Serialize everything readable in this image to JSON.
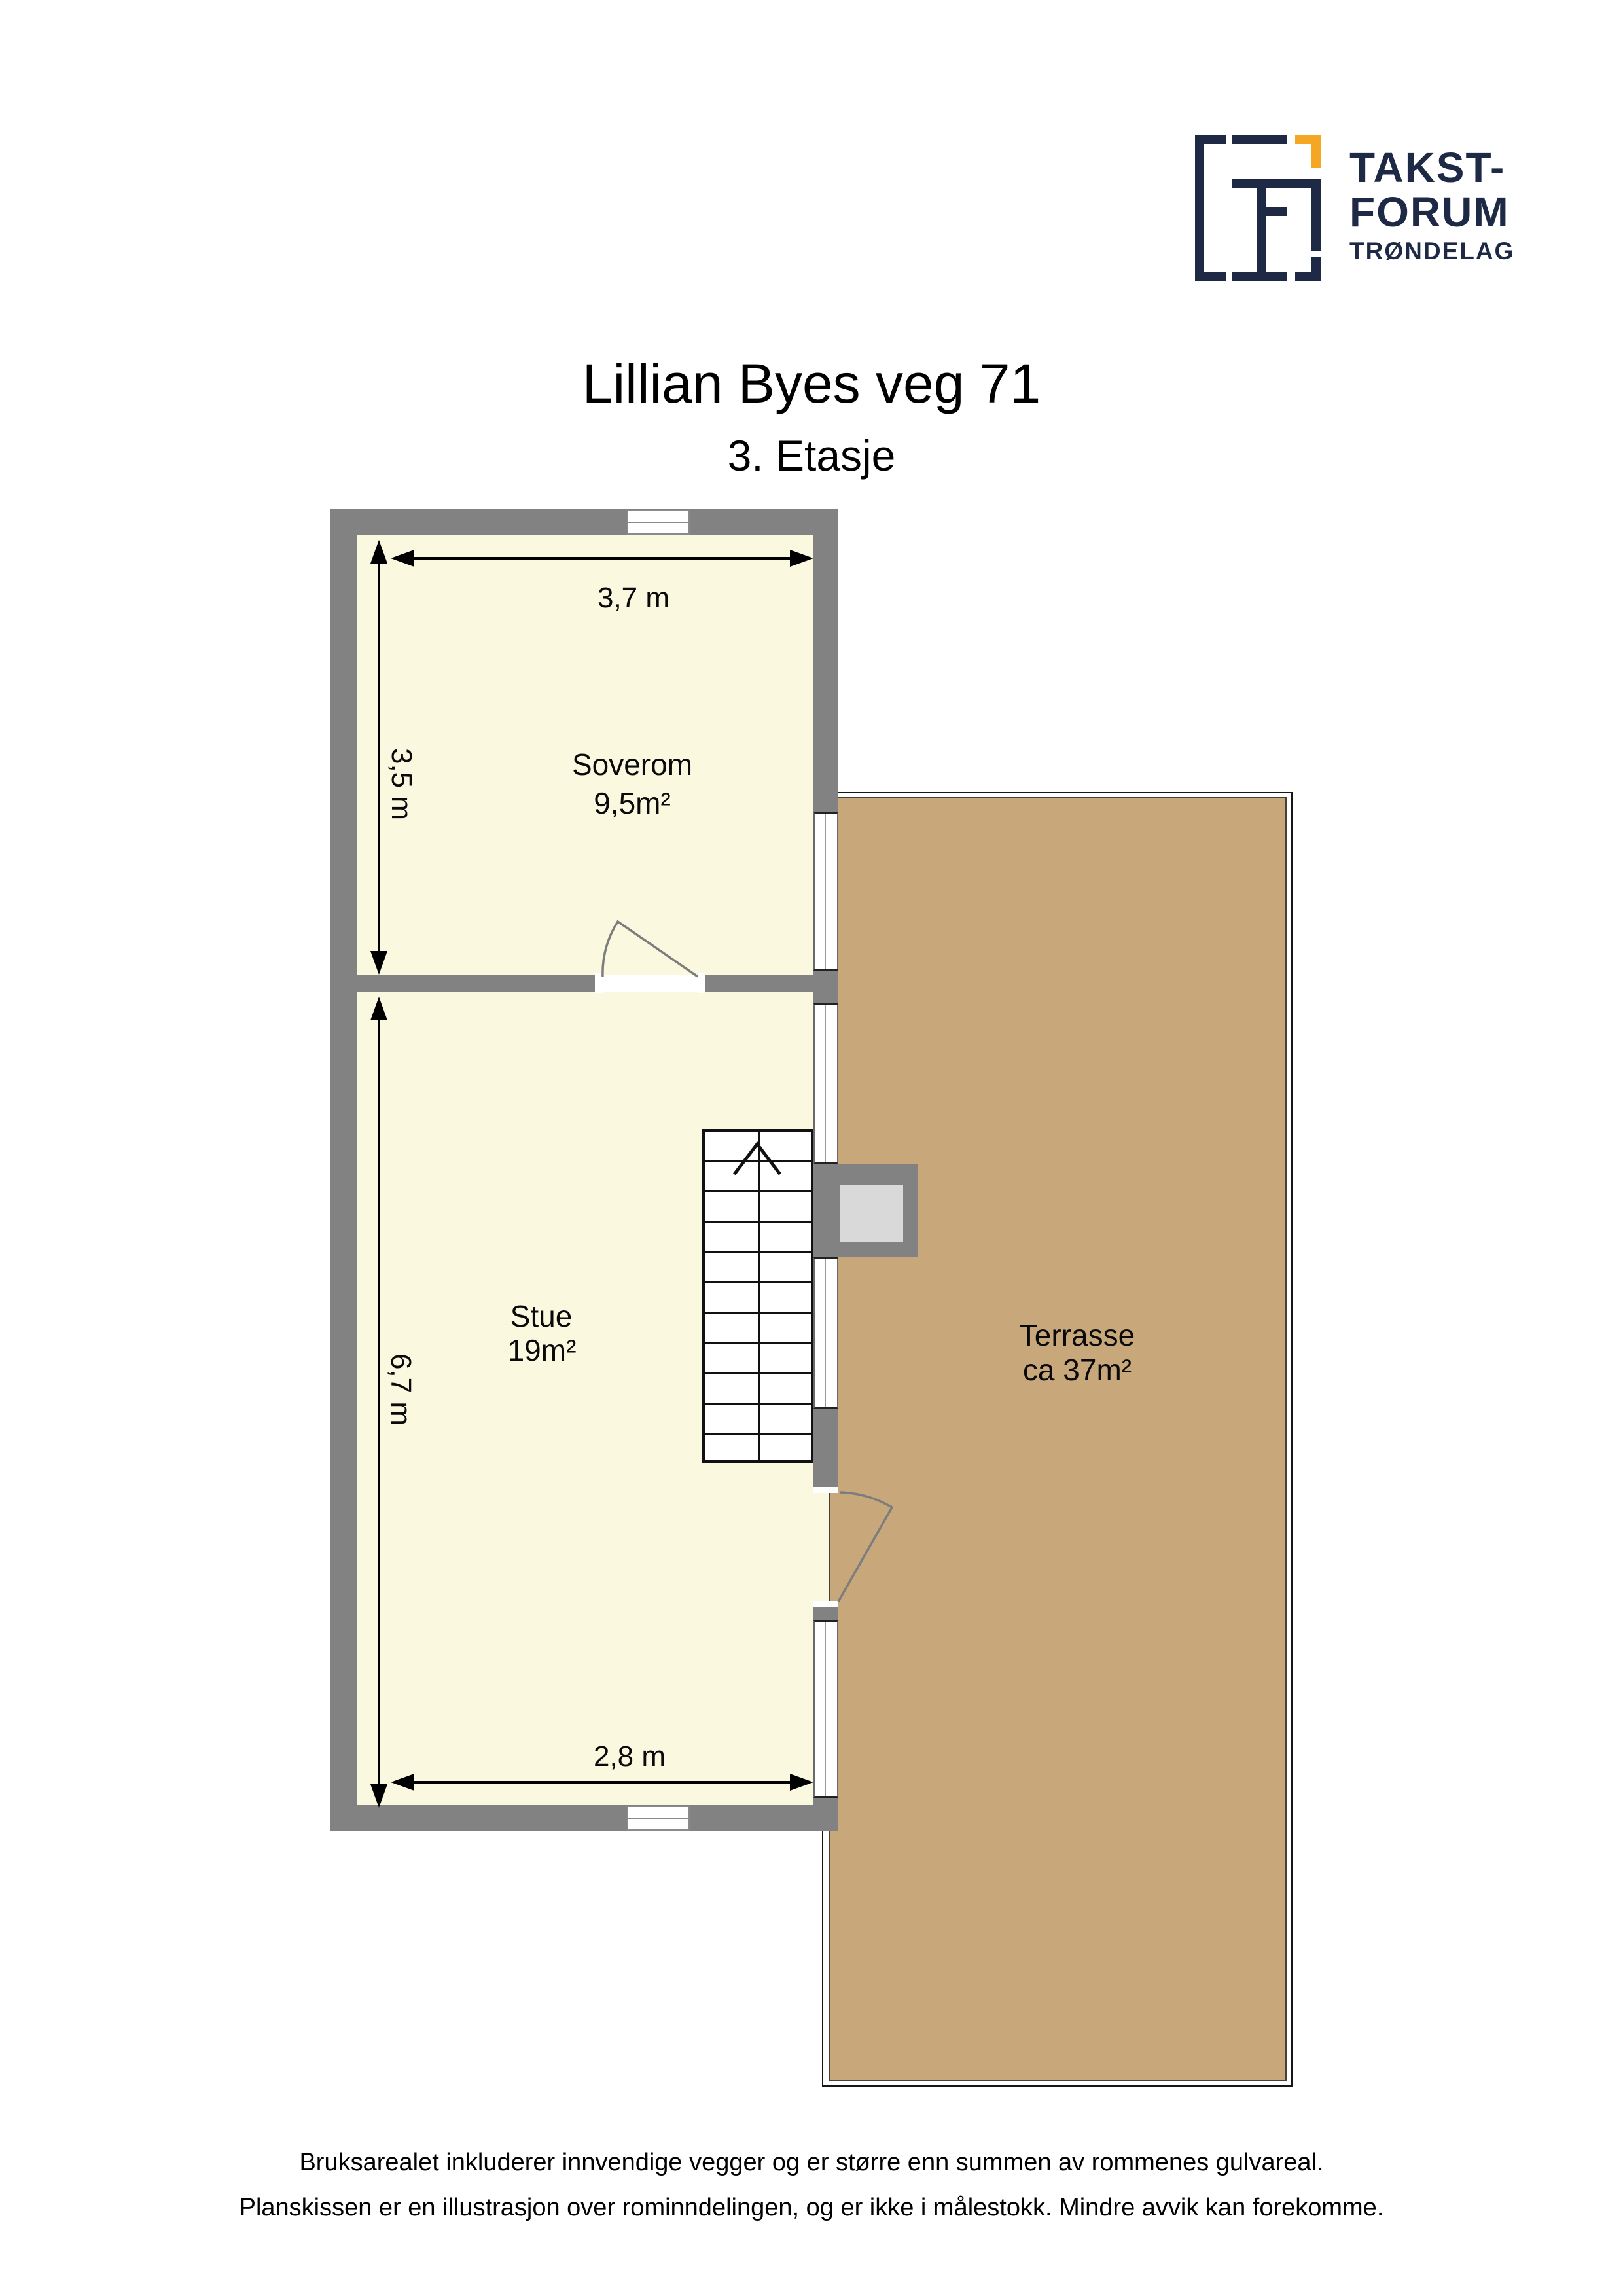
{
  "logo": {
    "line1": "TAKST-",
    "line2": "FORUM",
    "line3": "TRØNDELAG"
  },
  "header": {
    "title": "Lillian Byes veg 71",
    "subtitle": "3. Etasje"
  },
  "rooms": {
    "soverom": {
      "name": "Soverom",
      "area": "9,5m²"
    },
    "stue": {
      "name": "Stue",
      "area": "19m²"
    },
    "terrasse": {
      "name": "Terrasse",
      "area": "ca 37m²"
    }
  },
  "dimensions": {
    "soverom_width": "3,7 m",
    "soverom_height": "3,5 m",
    "stue_height": "6,7 m",
    "stue_width": "2,8 m"
  },
  "footer": {
    "line1": "Bruksarealet inkluderer innvendige vegger og er større enn summen av rommenes gulvareal.",
    "line2": "Planskissen er en illustrasjon over rominndelingen, og er ikke i målestokk. Mindre avvik kan forekomme."
  },
  "colors": {
    "wall": "#828282",
    "room_fill": "#FBF8E0",
    "terrace_fill": "#C8A77B",
    "chimney_fill": "#D9D9D9",
    "logo_navy": "#1E2A45",
    "logo_orange": "#F5A623"
  }
}
